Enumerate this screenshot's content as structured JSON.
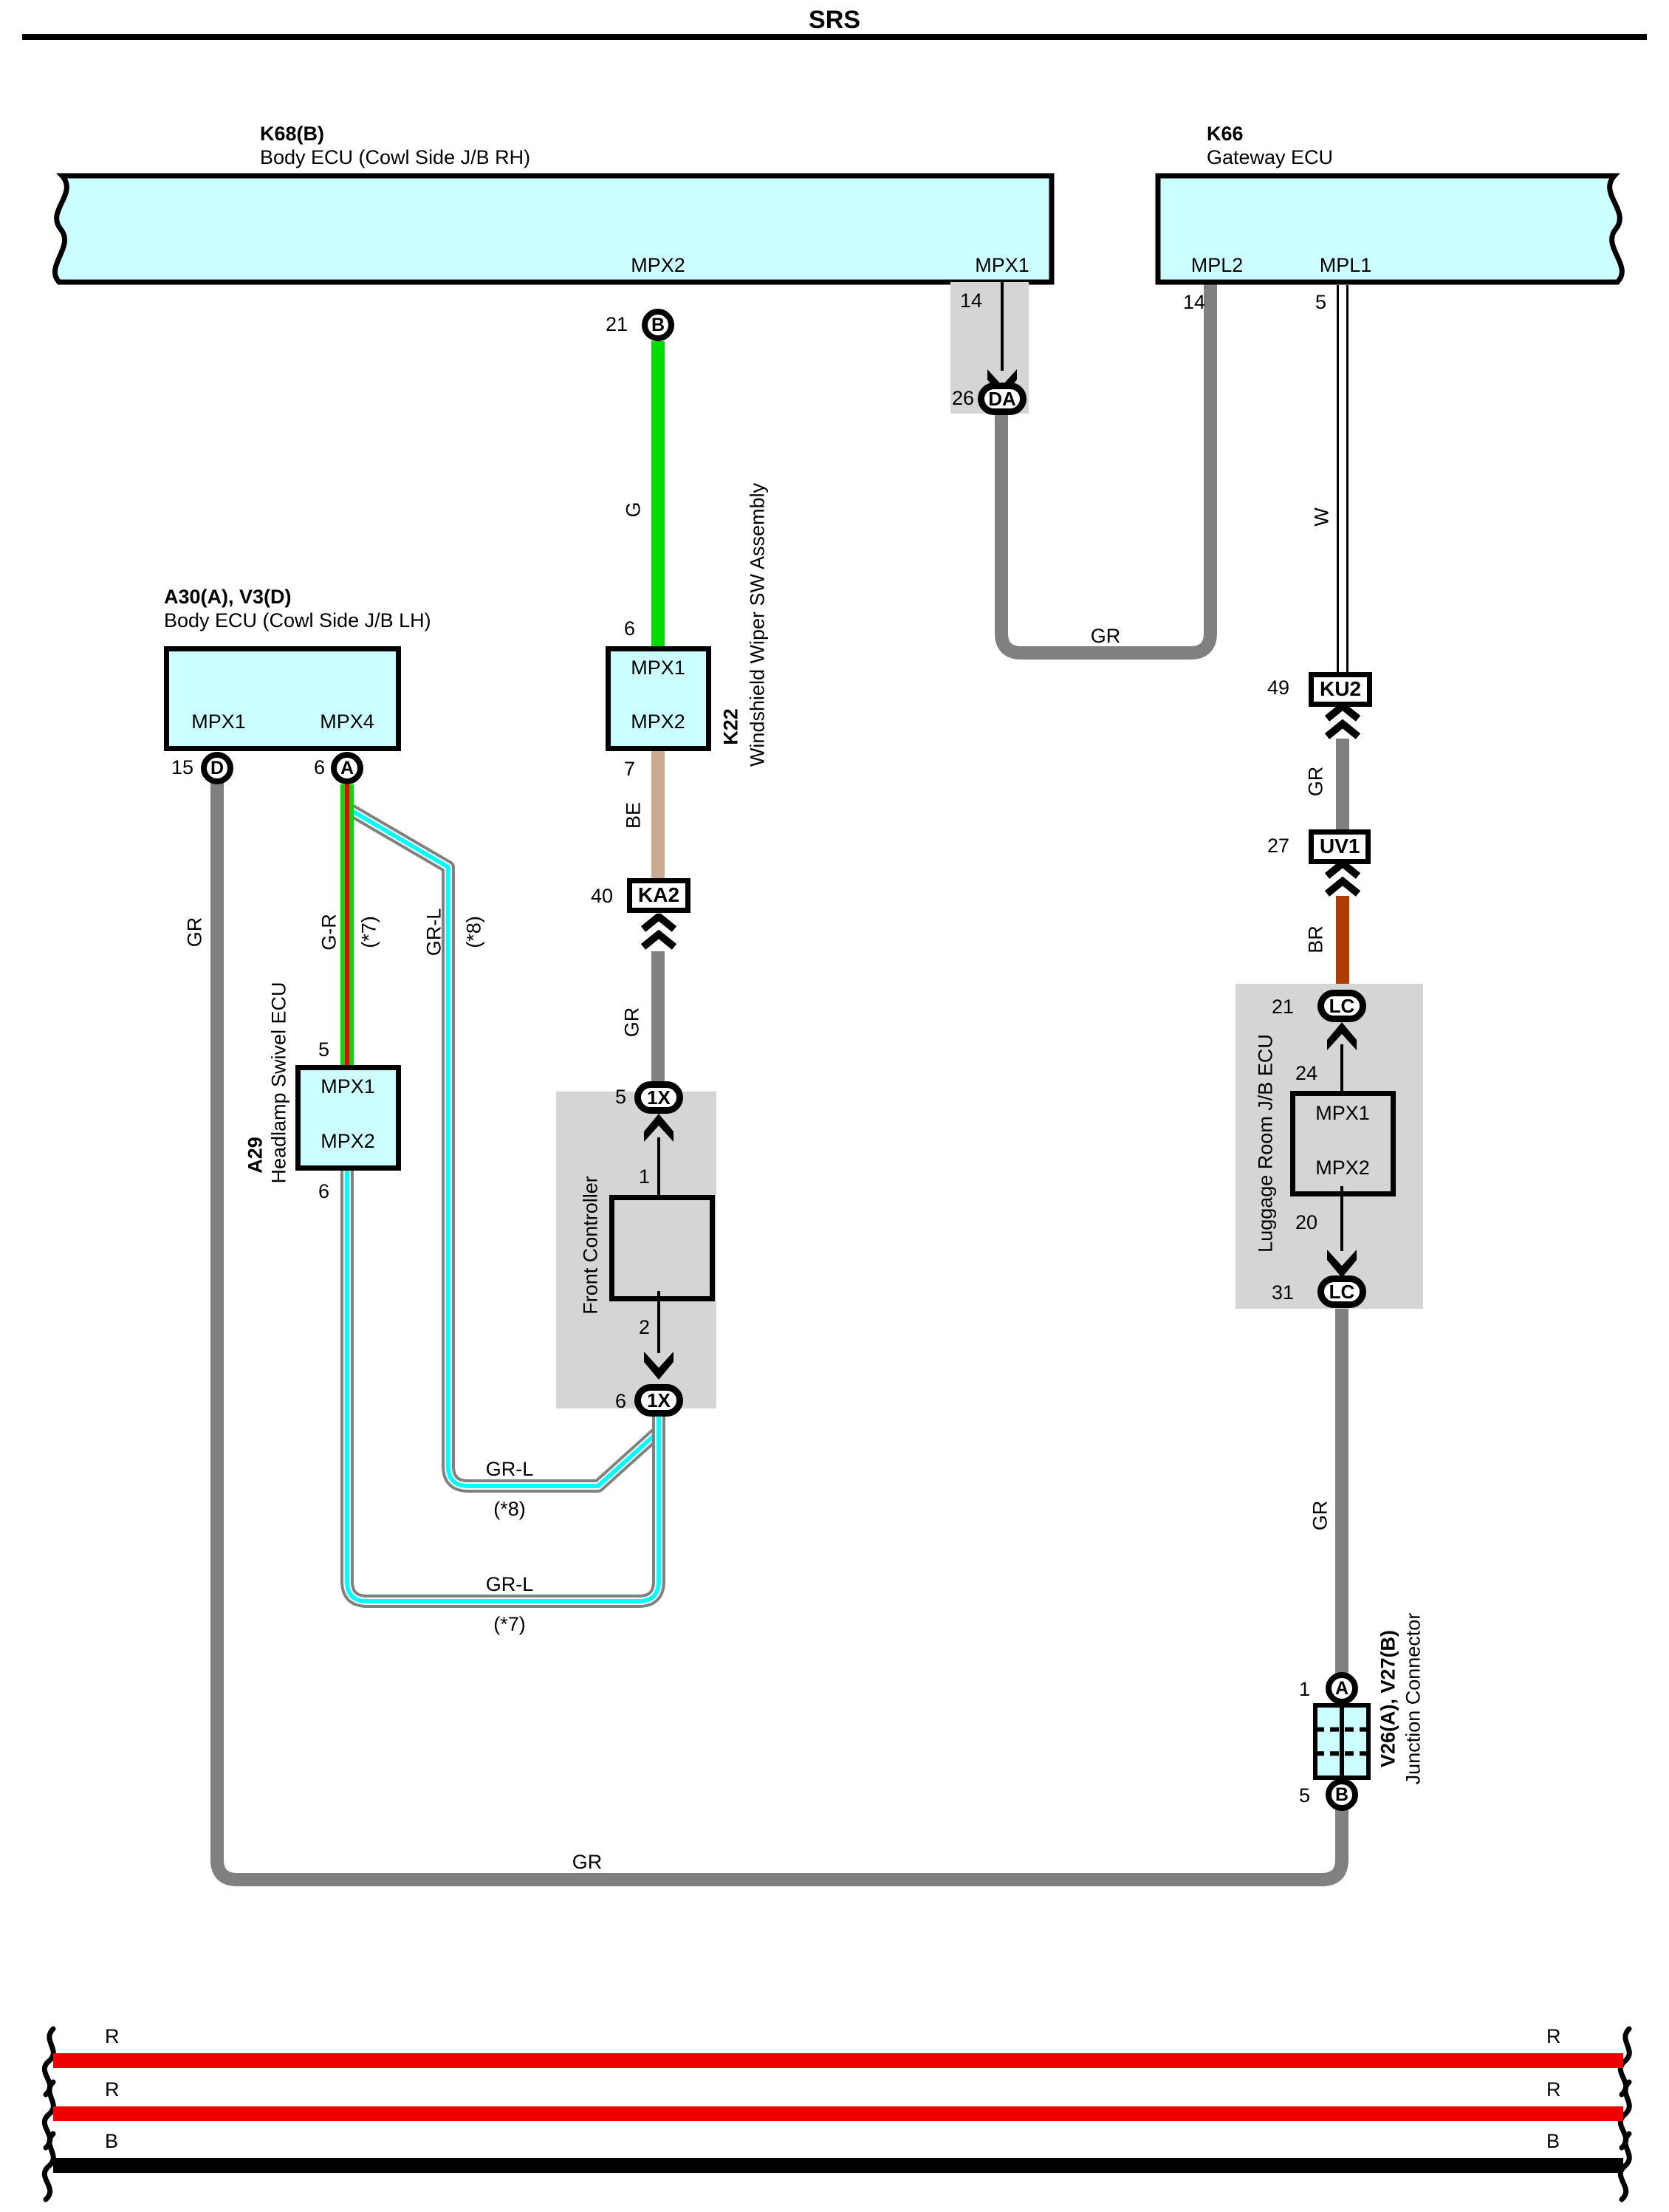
{
  "title": "SRS",
  "colors": {
    "block_fill": "#ccffff",
    "shade_fill": "#d5d5d5",
    "wire_gray": "#808080",
    "wire_green": "#00dc00",
    "wire_red_stripe": "#ee0000",
    "wire_beige": "#c9a98f",
    "wire_brown": "#b23c00",
    "wire_cyan_stripe": "#00ffff",
    "bottom_red": "#ee0000",
    "bottom_black": "#000000"
  },
  "blocks": {
    "k68": {
      "code": "K68(B)",
      "name": "Body ECU (Cowl Side J/B RH)",
      "pin_mpx2": "MPX2",
      "pin_mpx1": "MPX1"
    },
    "k66": {
      "code": "K66",
      "name": "Gateway ECU",
      "pin_mpl2": "MPL2",
      "pin_mpl1": "MPL1"
    },
    "a30": {
      "code": "A30(A), V3(D)",
      "name": "Body ECU (Cowl Side J/B LH)",
      "pin_mpx1": "MPX1",
      "pin_mpx4": "MPX4"
    },
    "k22": {
      "code": "K22",
      "name": "Windshield Wiper SW Assembly",
      "pin_mpx1": "MPX1",
      "pin_mpx2": "MPX2"
    },
    "a29": {
      "code": "A29",
      "name": "Headlamp Swivel ECU",
      "pin_mpx1": "MPX1",
      "pin_mpx2": "MPX2"
    },
    "front_controller": {
      "name": "Front Controller",
      "pin_in": "1",
      "pin_out": "2"
    },
    "luggage": {
      "name": "Luggage Room J/B ECU",
      "pin_mpx1": "MPX1",
      "pin_mpx2": "MPX2",
      "pin_in": "24",
      "pin_out": "20"
    },
    "junction": {
      "code": "V26(A), V27(B)",
      "name": "Junction Connector"
    }
  },
  "pins": {
    "k68_mpx2": "21",
    "k68_mpx1": "14",
    "k66_mpl2": "14",
    "k66_mpl1": "5",
    "k22_top": "6",
    "k22_bottom": "7",
    "a30_mpx1": "15",
    "a30_mpx4": "6",
    "a29_top": "5",
    "a29_bottom": "6"
  },
  "connectors": {
    "b21": {
      "num": "21",
      "label": "B"
    },
    "da26": {
      "num": "26",
      "label": "DA"
    },
    "ka2": {
      "num": "40",
      "label": "KA2"
    },
    "ku2": {
      "num": "49",
      "label": "KU2"
    },
    "uv1": {
      "num": "27",
      "label": "UV1"
    },
    "x5": {
      "num": "5",
      "label": "1X"
    },
    "x6": {
      "num": "6",
      "label": "1X"
    },
    "lc21": {
      "num": "21",
      "label": "LC"
    },
    "lc31": {
      "num": "31",
      "label": "LC"
    },
    "d15": {
      "num": "15",
      "label": "D"
    },
    "a6": {
      "num": "6",
      "label": "A"
    },
    "ja1": {
      "num": "1",
      "label": "A"
    },
    "jb5": {
      "num": "5",
      "label": "B"
    }
  },
  "wire_labels": {
    "g": "G",
    "gr": "GR",
    "be": "BE",
    "w": "W",
    "br": "BR",
    "g_r": "G-R",
    "gr_l": "GR-L",
    "star7": "(*7)",
    "star8": "(*8)"
  },
  "bottom_wires": {
    "r1": "R",
    "r2": "R",
    "b": "B"
  }
}
